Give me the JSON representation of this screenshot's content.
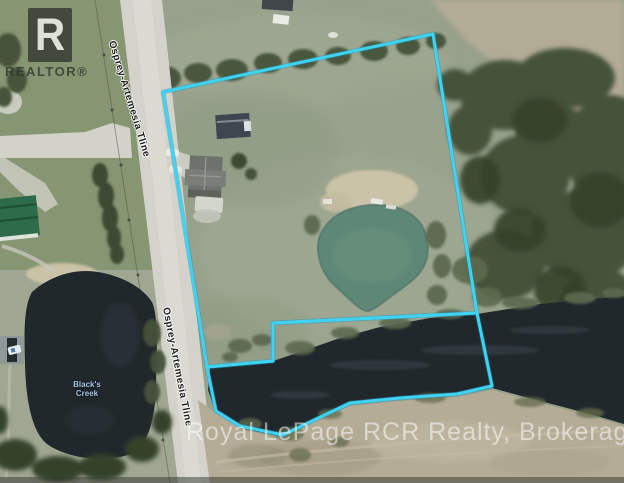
{
  "photo": {
    "description": "Aerial photo of rural property with cyan lot-line outline, pond, creek and road",
    "watermark": "Royal LePage RCR Realty, Brokerage",
    "logo": {
      "letter": "R",
      "word": "REALTOR®"
    },
    "labels": {
      "road": "Osprey-Artemesia Tline",
      "creek_line1": "Black's",
      "creek_line2": "Creek"
    },
    "colors": {
      "boundary": "#3fd2f2",
      "boundary_shadow": "#1f97b8",
      "water": "#20282c",
      "pond": "#5d8777",
      "road": "#d3d3cb",
      "grass": "#97a18b",
      "lawn": "#84936f",
      "field": "#b4ac97",
      "trees": "#44523a",
      "trees_dark": "#36422c",
      "green_roof": "#2e6b4a",
      "sand": "#cdc5a9"
    }
  }
}
